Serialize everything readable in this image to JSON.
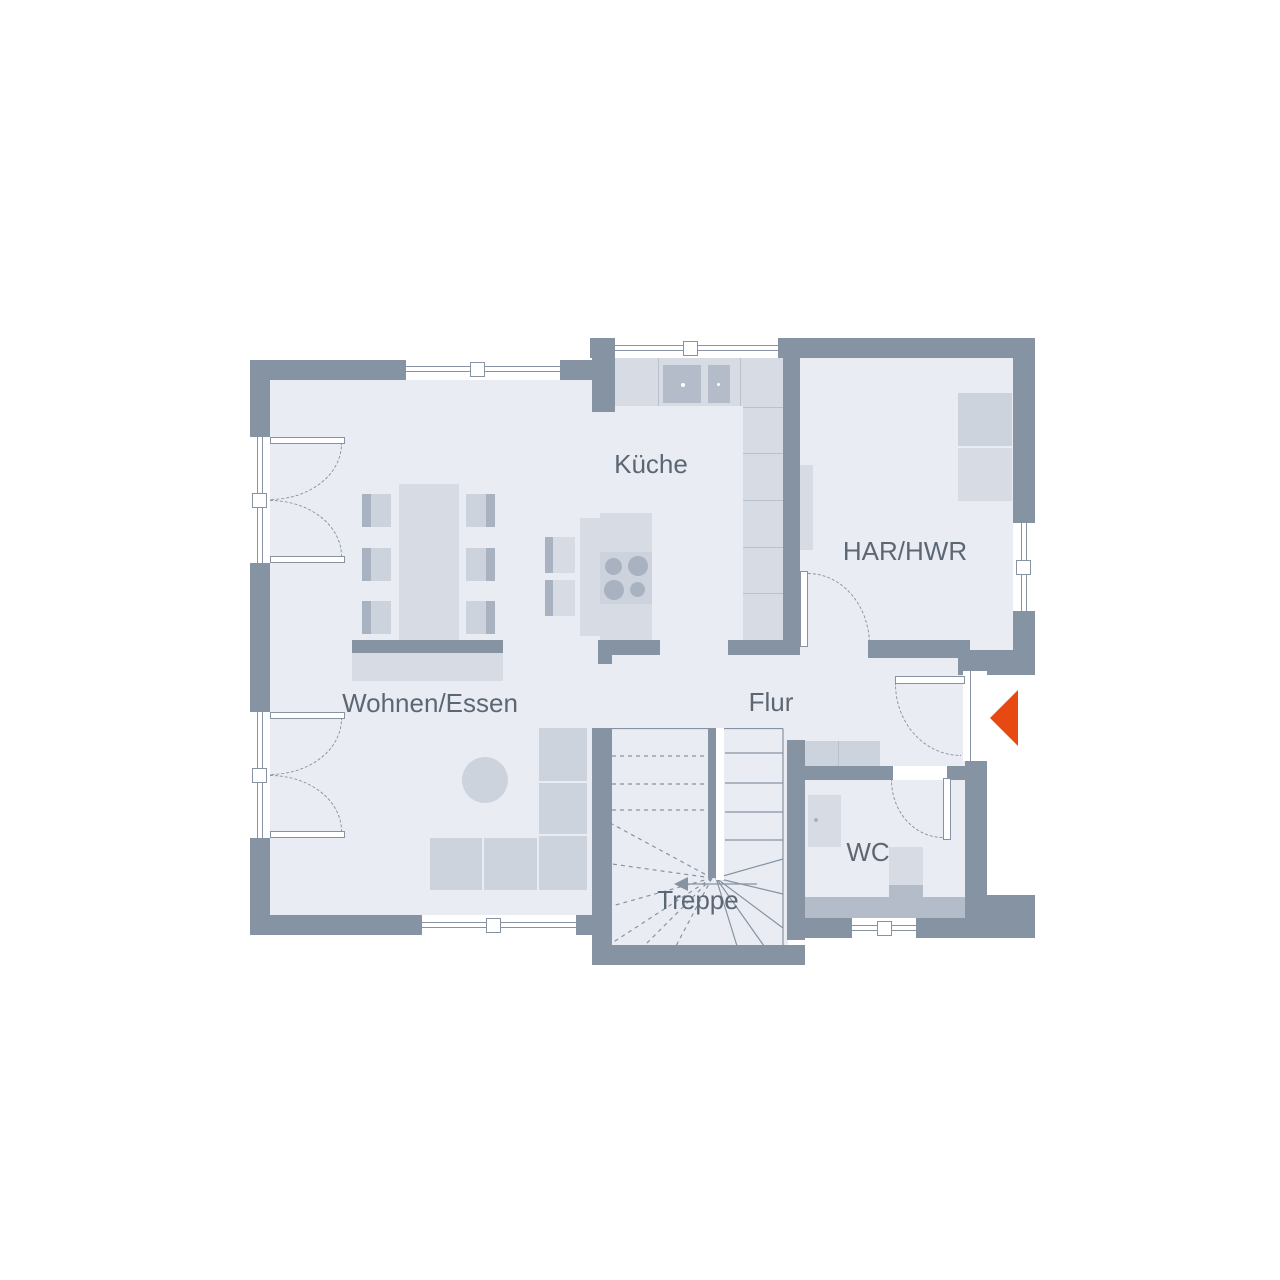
{
  "plan": {
    "type": "floor-plan",
    "floor_name": "Erdgeschoss"
  },
  "rooms": {
    "kueche": {
      "label": "Küche"
    },
    "har_hwr": {
      "label": "HAR/HWR"
    },
    "wohnen_essen": {
      "label": "Wohnen/Essen"
    },
    "flur": {
      "label": "Flur"
    },
    "wc": {
      "label": "WC"
    },
    "treppe": {
      "label": "Treppe"
    }
  },
  "entrance": {
    "marker": "left-pointing-triangle"
  },
  "colors": {
    "wall": "#8593a3",
    "wall-light": "#b3bcc8",
    "floor": "#e9edf3",
    "furn-light": "#d7dbe3",
    "furn-mid": "#cdd3dd",
    "furn-dark": "#a9b2c0",
    "furn-line": "#b9c1cd",
    "line": "#8793a3",
    "label": "#5d6774",
    "accent": "#e64a12"
  }
}
